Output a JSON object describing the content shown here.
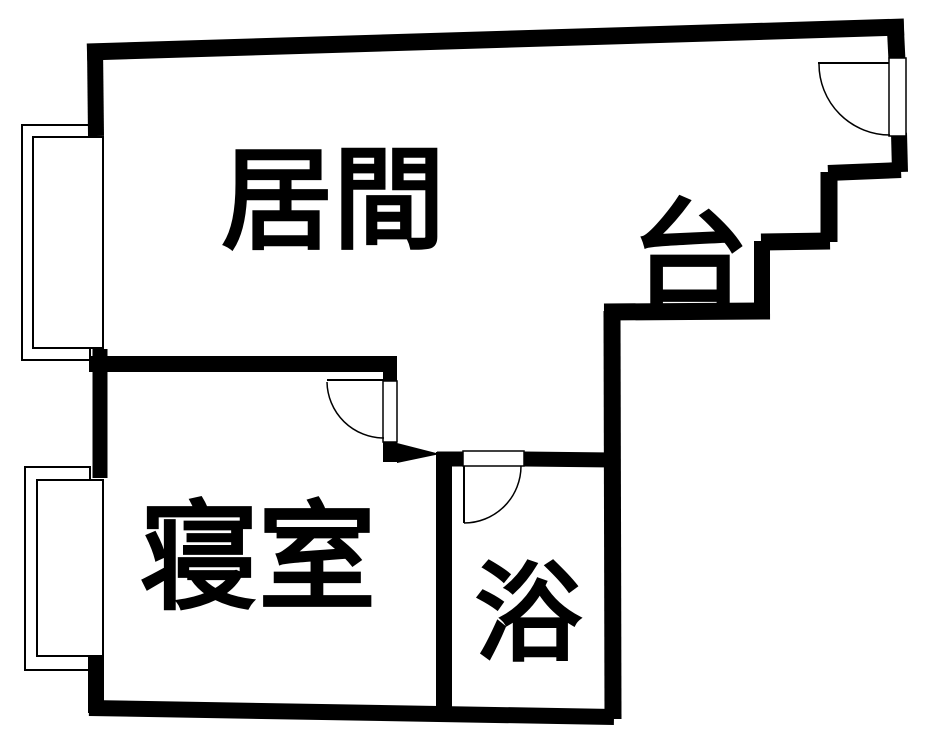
{
  "floor_plan": {
    "background_color": "#ffffff",
    "wall_color": "#000000",
    "rooms": [
      {
        "name": "living-room",
        "label": "居間"
      },
      {
        "name": "kitchen",
        "label": "台"
      },
      {
        "name": "bedroom",
        "label": "寝室"
      },
      {
        "name": "bathroom",
        "label": "浴"
      }
    ],
    "doors": [
      {
        "name": "entrance-door",
        "type": "swing"
      },
      {
        "name": "bedroom-door",
        "type": "swing"
      },
      {
        "name": "bathroom-door",
        "type": "swing"
      }
    ],
    "windows": [
      {
        "name": "window-upper-left"
      },
      {
        "name": "window-lower-left"
      }
    ]
  }
}
